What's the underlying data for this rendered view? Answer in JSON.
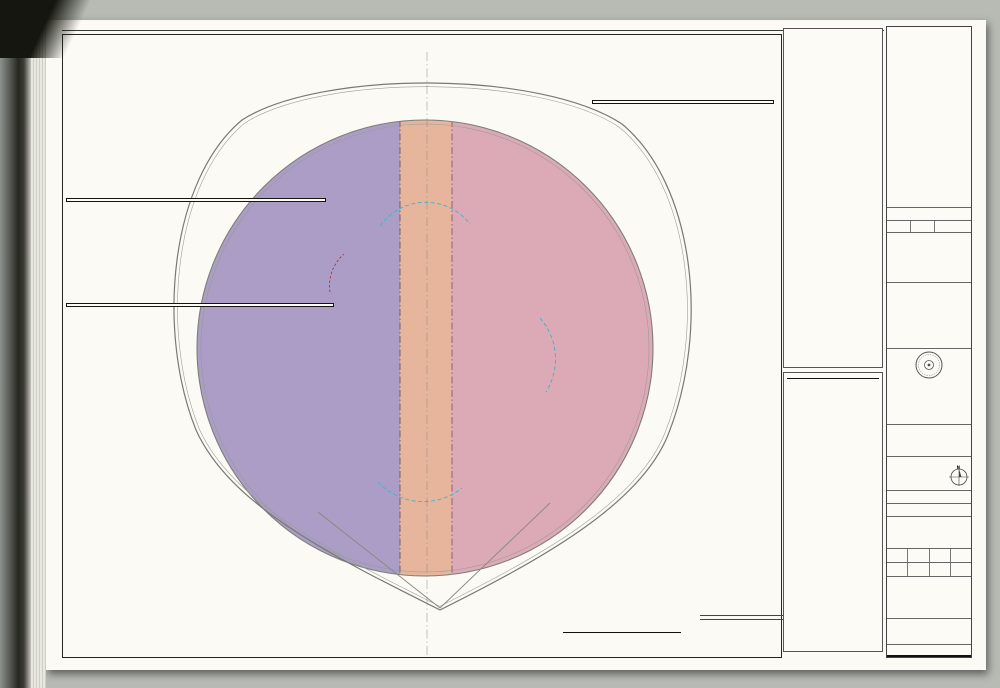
{
  "colors": {
    "zone_purple": "#ab9dc5",
    "zone_pink": "#dcaab6",
    "zone_salmon": "#e7b59b",
    "room_orange": "#f2b887",
    "vestibule_blue": "#82c3df",
    "column_gray": "#a4a89f",
    "accent_red": "#c9201d",
    "accent_green": "#2f9e44",
    "gensler_red": "#cf382c",
    "cyan_dash": "#3fb3c9"
  },
  "plan": {
    "grid_bubbles": [
      {
        "label": "10.7",
        "x": 334,
        "y": 63
      },
      {
        "label": "12.4",
        "x": 428,
        "y": 45
      },
      {
        "label": "13.3",
        "x": 502,
        "y": 60
      },
      {
        "label": "DD.5",
        "x": 292,
        "y": 90
      },
      {
        "label": "FF.5",
        "x": 541,
        "y": 91
      },
      {
        "label": "CC",
        "x": 207,
        "y": 150
      },
      {
        "label": "HH",
        "x": 626,
        "y": 151
      },
      {
        "label": "AA.5",
        "x": 152,
        "y": 234
      },
      {
        "label": "JJ.5",
        "x": 689,
        "y": 226
      },
      {
        "label": "J.8",
        "x": 128,
        "y": 277
      },
      {
        "label": "J.8",
        "x": 713,
        "y": 267
      },
      {
        "label": "H.6",
        "x": 116,
        "y": 331
      },
      {
        "label": "H.6",
        "x": 725,
        "y": 324
      },
      {
        "label": "G.4",
        "x": 727,
        "y": 380
      },
      {
        "label": "F.2",
        "x": 130,
        "y": 446
      },
      {
        "label": "F.2",
        "x": 718,
        "y": 437
      },
      {
        "label": "LL.5",
        "x": 693,
        "y": 481
      },
      {
        "label": "ZZ.3",
        "x": 618,
        "y": 352
      },
      {
        "label": "UU.5",
        "x": 158,
        "y": 489
      },
      {
        "label": "TT",
        "x": 216,
        "y": 569
      },
      {
        "label": "NN",
        "x": 634,
        "y": 561
      },
      {
        "label": "RR.5",
        "x": 298,
        "y": 629
      },
      {
        "label": "PP.5",
        "x": 557,
        "y": 622
      },
      {
        "label": "11.6",
        "x": 404,
        "y": 660
      },
      {
        "label": "12.4",
        "x": 459,
        "y": 662
      },
      {
        "label": "13.3",
        "x": 507,
        "y": 648
      }
    ],
    "stair_labels": [
      {
        "pos": "tl",
        "zh1": "安全疏散楼梯",
        "en1": "EGRESS STAIR",
        "grade": "TO GRADE",
        "zh2": "梯段宽",
        "en2": "STAIR WIDTH:",
        "width": "1.2M"
      },
      {
        "pos": "tm",
        "zh1": "安全疏散楼梯",
        "en1": "EGRESS STAIR",
        "grade": "TO GRADE",
        "zh2": "梯段宽",
        "en2": "STAIR WIDTH:",
        "width": "1.2M"
      },
      {
        "pos": "bl",
        "zh1": "安全疏散楼梯",
        "en1": "EGRESS STAIR",
        "grade": "TO GRADE",
        "zh2": "梯段宽",
        "en2": "STAIR WIDTH:",
        "width": "1.2M"
      },
      {
        "pos": "bm",
        "zh1": "安全疏散楼梯",
        "en1": "EGRESS STAIR",
        "grade": "TO GRADE",
        "zh2": "梯段宽",
        "en2": "STAIR WIDTH:",
        "width": "1.40M"
      }
    ],
    "zone_boxes": {
      "fz242": {
        "zh": "防火分区  24-2",
        "zh_val": "1507 平方米",
        "en": "FIRE ZONE 24-2",
        "en_val": "1507  sm"
      },
      "core": {
        "zh": "核心筒",
        "zh_val": "1093 平方米",
        "en": "CORE",
        "en_val": "1093  sm"
      },
      "fz241": {
        "zh": "防火分区  24-1",
        "zh_val": "1353 平方米",
        "en": "FIRE ZONE 24-1",
        "en_val": "1353  sm"
      }
    },
    "office_labels": [
      {
        "zh": "办公",
        "en": "OFFICE",
        "x": 249,
        "y": 322
      },
      {
        "zh": "办公",
        "en": "OFFICE",
        "x": 552,
        "y": 326
      }
    ]
  },
  "calc_col_zh": {
    "title1": "防火分区疏散宽度计算：",
    "title2": "第24层：",
    "sections": [
      {
        "heading": "防火分区 24-1",
        "lines": [
          "防火分区面积",
          "1,353平米 总建筑面积",
          "防火分区疏散人数计算",
          "办公 = 1,353平米/9.3平米/人",
          "= 134 人",
          "柱子 = 62.1平米 (无人)",
          "防火分区总人数",
          "= 134 人",
          "所需疏散宽度",
          "134/100x1.1 = 1.34米",
          "实际疏散宽度",
          "2.4米 (包括共用楼梯全宽)"
        ]
      },
      {
        "heading": "防火分区 24-2",
        "lines": [
          "防火分区面积",
          "1,507平米 总建筑面积",
          "防火分区疏散人数计算",
          "办公 = 1,507平米/9.3平米/人",
          "= 152 人",
          "柱子 = 62.1平米 (无人)",
          "防火分区总人数",
          "= 152 人",
          "所需疏散宽度",
          "152/100x1.1 = 1.52米",
          "实际疏散宽度",
          "2.4米 (包括共用楼梯全宽)"
        ]
      },
      {
        "heading": "核心筒",
        "lines": [
          "核心筒面积 = 1,093平米 (无人)"
        ]
      },
      {
        "heading": "防火分区总疏散宽度计算 24层：",
        "lines": [
          "防火分区24-1需要1.34米疏散宽度",
          "防火分区24-2需要1.52米疏散宽度",
          "所需总疏散宽度 = 2.86米",
          "实际总疏散宽度 = 5.20米"
        ]
      }
    ]
  },
  "calc_panel": {
    "title1": "FIREZONE EGRESS CALCULATIONS",
    "title2": "LEVEL 24:",
    "sections": [
      {
        "heading": "FIREZONE 24-1",
        "lines": [
          "FIREZONE AREA",
          "1,353SM GFA",
          "FIREZONE OCCUPANCY LOAD BREAKDOWN",
          "OFFICE = 1,353 SM/9.3SM PER PERSON",
          "   = 134 PERSONS",
          "COLUMNS = 62.1SM (NO OCCUPANCY)",
          "OCCUPANT LOAD IN FIREZONE",
          "   = 134 PERSONS",
          "REQUIRED EXIT WIDTH",
          "134/100x1.1 = 1.34M",
          "PROVIDED EXIT WIDTH",
          "2.4M (INCLUDES FULL WIDTH OF SHARED STAIR)"
        ]
      },
      {
        "heading": "FIREZONE 24-2",
        "lines": [
          "FIREZONE AREA",
          "1,507SM GFA",
          "FIREZONE OCCUPANCY LOAD BREAKDOWN",
          "OFFICE = 1,507 SM/9.3SM PER PERSON",
          "   = 152 PERSONS",
          "COLUMNS = 62.1SM (NO OCCUPANCY)",
          "OCCUPANT LOAD IN FIREZONE",
          "   = 152 PERSONS",
          "REQUIRED EXIT WIDTH",
          "152/100x1.1 = 1.52M",
          "PROVIDED EXIT WIDTH",
          "2.4M (INCLUDES FULL WIDTH OF SHARED STAIR)"
        ]
      },
      {
        "heading": "CORE",
        "lines": [
          "CORE AREA = 1,093SM (NO OCCUPANCY)"
        ]
      }
    ],
    "gross_title1": "GROSS FIREZONE EGRESS",
    "gross_title2": "CALCULATION LEVEL 24:",
    "gross_lines": [
      "FIREZONE 24-1 REQUIRES 1.34M EXIT WIDTH",
      "FIREZONE 24-2 REQUIRES 1.52M EXIT WIDTH",
      "REQUIRED TOTAL EXIT WIDTH = 2.86M",
      "PROVIDED TOTAL EXIT WIDTH = 5.20M"
    ]
  },
  "legend": {
    "title_zh": "图例说明",
    "title_en": "LEGEND",
    "note_zh": "备注: 3小时防火墙开口处须设3小时防火卷帘或1.5小时防火门。",
    "note_en": "NOTE: 3 HR FIRE ZONE WALL WITH 3 HR SHUTTER AT OPENINGS OR 1.5HR FIRE DOORS.",
    "items": [
      {
        "symbol": "fhc",
        "zh": "消防栓",
        "en": "FIRE HOSE CABINET"
      },
      {
        "symbol": "red-dash",
        "zh": "防火卷帘",
        "en": "FIRE SHUTTER"
      },
      {
        "symbol": "angle",
        "zh": "表示2个疏散最近的出口之间的直线角度",
        "en": "INDICATES STRAIGHT LINE ANGLE BETWEEN THE 2 NEAREST MEANS OF EGRESS"
      },
      {
        "symbol": "cyan-dash",
        "zh": "疏散距离限制（开放办公平面为30M，多租户平面为15M）",
        "en": "LIMIT OF TRAVEL DISTANCE (30M OPEN OFFICE PLAN AND 15M MULTI TENANT)"
      },
      {
        "symbol": "cyan-dash",
        "zh": "疏散距离限制（大空间和商业直线为20M）",
        "en": "LIMIT OF TRAVEL DISTANCE (20M FOR BIG ROOMS AND 20M STRAIGHT LINE FOR RETAIL)"
      },
      {
        "symbol": "red-dash-short",
        "zh": "开放办公平面中2个最近出口之间角度小于45度处的12M疏散距离限制",
        "en": "LIMIT OF 12M TRAVEL DISTANCE IN OPEN OFFICE PLAN WHERE ANGLE BETWEEN EXITS IS LESS THAN 45"
      },
      {
        "symbol": "blue-rect",
        "zh": "消防前室",
        "en": "VESTIBULE"
      },
      {
        "symbol": "red-rect",
        "zh": "红色填充表示通向疏散出口宽度不足的区域",
        "en": "RED HATCH INDICATES AREAS WITH INSUFFICIENT ACCESS TO MEANS OF EGRESS"
      },
      {
        "symbol": "red-hatch",
        "zh": "填充区域表示2个最近出口间角度小于45度且疏散距离因此限制为12M的区域",
        "en": "HATCH INDICATES AREAS WHERE ANGLE BETWEEN THE 2 NEAREST MEANS OF EGRESS IS LESS THAN 45 AND TRAVEL DISTANCE IS THEREFORE LIMITED TO 12M"
      },
      {
        "symbol": "black-line",
        "zh": "3 小时防火墙",
        "en": "3 HOURS FIRE-RATING WALL"
      },
      {
        "symbol": "dash-dot",
        "zh": "防火分区边界",
        "en": "BOUNDARY OF FIREZONE"
      },
      {
        "symbol": "tri-red",
        "zh": "疏散出口（直接到疏散楼梯前室或室外）",
        "en": "DIRECT EXIT TO FIRE STAIR VESTIBULE OR GRADE"
      },
      {
        "symbol": "tri-green",
        "zh": "楼梯（仅直接通至避难区）",
        "en": "STAIR WITH DIRECT EXIT TO REFUGE AREA ONLY"
      },
      {
        "symbol": "circle-red",
        "zh": "消防电梯",
        "en": "FIREMAN LIFT"
      },
      {
        "symbol": "half-red",
        "zh": "备用消防疏散电梯",
        "en": "SUPPLEMENTAL FIRE EVACUATION LIFT"
      },
      {
        "symbol": "arrows",
        "zh": "疏散至相邻防火分区",
        "en": "EXIT TO ADJACENT FIRE ZONE"
      }
    ]
  },
  "scalebar": {
    "ticks": [
      "0",
      "2.5m",
      "5m",
      "10m",
      "20m"
    ]
  },
  "levelinfo": {
    "finish_zh": "建筑完成面",
    "finish_en": "Top of Finish Floor",
    "finish_val": "+113.65",
    "slab_zh": "结构完成面",
    "slab_en": "Top of Structural Slab",
    "slab_val": "+113.50",
    "level_zh": "楼层",
    "level_en": "Level",
    "level_val": "024",
    "loc_zh": "位置",
    "loc_en": "Location",
    "loc_val": "203-03"
  },
  "titleblock": {
    "rev_entry": {
      "date": "2009/04/20",
      "desc_zh": "扩初设计",
      "desc_en": "DESIGN DEVELOPMENT SUBMITTAL"
    },
    "rev_header": {
      "no_zh": "序号",
      "no_en": "Rev.",
      "date_zh": "日期",
      "date_en": "Date",
      "desc_zh": "修改说明",
      "desc_en": "Description"
    },
    "client": {
      "label_zh": "建设单位",
      "label_en": "Client",
      "name_zh1": "上海中心大厦建设发展",
      "name_zh2": "有限公司",
      "name_en1": "SHANGHAI TOWER",
      "name_en2": "CONSTRUCTION & DEVELOPMENT",
      "name_en3": "CO., LTD"
    },
    "architect": {
      "label_zh": "设计单位",
      "label_en": "Design Architect",
      "logo": "Gensler",
      "addr": [
        "Platinum, Suite 503",
        "No.233 Taicang Road",
        "Shanghai, China, 200020",
        "Telephone: 8621 6123 1065",
        "Facsimile: 8621 6123 1066"
      ],
      "copyright": "© 2009 Gensler"
    },
    "institute": {
      "label_zh": "合作设计单位",
      "label_en": "Design Institute",
      "name_zh": "同济大学建筑设计研究院",
      "name_en1": "THE ARCHITECTURAL DESIGN & RESEARCH",
      "name_en2": "INSTITUTE OF TONGJI UNIVERSITY",
      "addr_zh": "中国 上海 四平路1230号 (邮编 200092)",
      "addr_en": "1230 SIPING RD. SHANGHAI 200092 P.R.C",
      "tel": "Tel: 021-65987788  Fax: 021-65983414"
    },
    "consultants": {
      "label_zh": "设计顾问",
      "label_en": "Design Consultants"
    },
    "project": {
      "label_zh": "工程名称",
      "label_en": "Project Title",
      "name_zh": "上海中心大厦",
      "name_en": "SHANGHAI TOWER"
    },
    "project_no": {
      "label_zh": "工程编号",
      "label_en": "Project No.",
      "value": "S0.7053.000"
    },
    "subject": {
      "label_zh": "项目名称",
      "label_en": "Subject"
    },
    "sign_rows": [
      {
        "zh": "审  定",
        "en": "Approved by"
      },
      {
        "zh": "审  核",
        "en": "Final Check"
      },
      {
        "zh": "校  对",
        "en": "Checked by"
      },
      {
        "zh": "工程负责人",
        "en": "Chief Architect / Engineer"
      },
      {
        "zh": "专业负责人",
        "en": "Architect / Engineer"
      },
      {
        "zh": "设  计",
        "en": "Designed by"
      },
      {
        "zh": "制  图",
        "en": "Drawn by"
      }
    ],
    "date_zh": "日期",
    "date_en": "Date",
    "drawing_title": {
      "label_zh": "图纸名称",
      "label_en": "Drawing Title",
      "zh": "二十四层防火分区图",
      "en": "FIRE ZONE PLAN - LEVEL 024"
    },
    "spec_row": {
      "a_zh": "专业",
      "a_en": "Specialty",
      "b_zh": "建筑",
      "b_en": "ARCHITECTURE",
      "c_zh": "设计阶段",
      "c_en": "Design Stage",
      "d": "D.D."
    },
    "scale_row": {
      "a_zh": "比例",
      "a_en": "Scale",
      "b1": "A3 1:400",
      "b2": "A1 1:200",
      "c_zh": "修改版次",
      "c_en": "Revision",
      "d": ""
    },
    "release": {
      "label_zh": "出图签章",
      "label_en": "Release Approval"
    },
    "number": {
      "label_zh": "编号",
      "label_en": "Drawing Number",
      "value": "A0-900-024-A"
    },
    "note": {
      "zh": "未经加盖本院出图签章，图纸一律无效",
      "en": "Invalid Unless Stamped"
    }
  }
}
